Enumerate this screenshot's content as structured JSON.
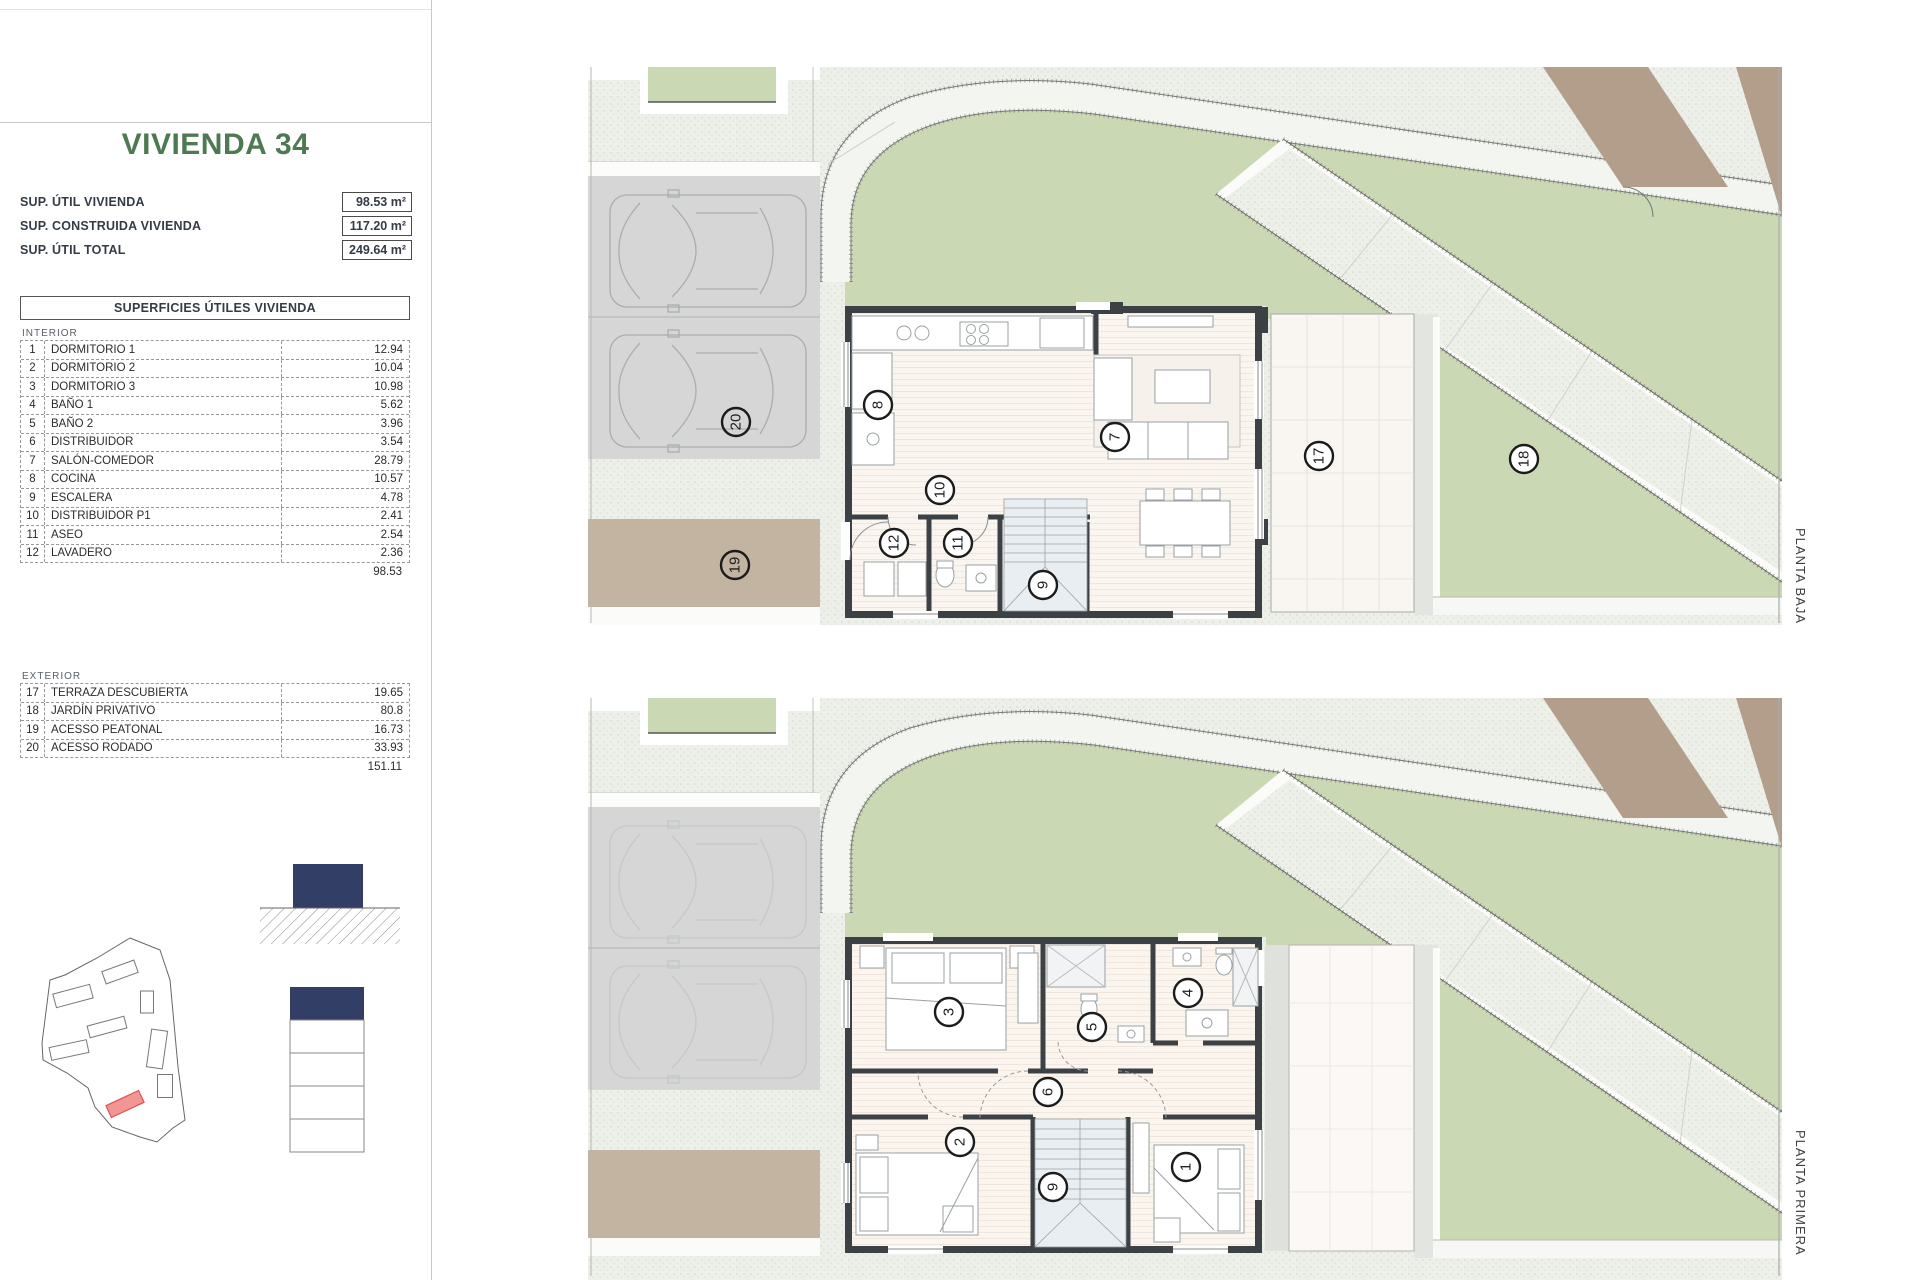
{
  "header": {
    "title": "VIVIENDA 34",
    "summary": [
      {
        "label": "SUP. ÚTIL VIVIENDA",
        "value": "98.53 m²"
      },
      {
        "label": "SUP. CONSTRUIDA VIVIENDA",
        "value": "117.20 m²"
      },
      {
        "label": "SUP. ÚTIL TOTAL",
        "value": "249.64 m²"
      }
    ]
  },
  "areas_table": {
    "title": "SUPERFICIES ÚTILES VIVIENDA",
    "interior": {
      "section_label": "INTERIOR",
      "rows": [
        {
          "num": "1",
          "name": "DORMITORIO 1",
          "value": "12.94"
        },
        {
          "num": "2",
          "name": "DORMITORIO 2",
          "value": "10.04"
        },
        {
          "num": "3",
          "name": "DORMITORIO 3",
          "value": "10.98"
        },
        {
          "num": "4",
          "name": "BAÑO 1",
          "value": "5.62"
        },
        {
          "num": "5",
          "name": "BAÑO 2",
          "value": "3.96"
        },
        {
          "num": "6",
          "name": "DISTRIBUIDOR",
          "value": "3.54"
        },
        {
          "num": "7",
          "name": "SALÓN-COMEDOR",
          "value": "28.79"
        },
        {
          "num": "8",
          "name": "COCINA",
          "value": "10.57"
        },
        {
          "num": "9",
          "name": "ESCALERA",
          "value": "4.78"
        },
        {
          "num": "10",
          "name": "DISTRIBUIDOR P1",
          "value": "2.41"
        },
        {
          "num": "11",
          "name": "ASEO",
          "value": "2.54"
        },
        {
          "num": "12",
          "name": "LAVADERO",
          "value": "2.36"
        }
      ],
      "total": "98.53"
    },
    "exterior": {
      "section_label": "EXTERIOR",
      "rows": [
        {
          "num": "17",
          "name": "TERRAZA DESCUBIERTA",
          "value": "19.65"
        },
        {
          "num": "18",
          "name": "JARDÍN PRIVATIVO",
          "value": "80.8"
        },
        {
          "num": "19",
          "name": "ACESSO PEATONAL",
          "value": "16.73"
        },
        {
          "num": "20",
          "name": "ACESSO RODADO",
          "value": "33.93"
        }
      ],
      "total": "151.11"
    }
  },
  "plans": {
    "baja": {
      "side_label": "PLANTA BAJA",
      "rooms": {
        "cocina": "8",
        "salon": "7",
        "hall": "10",
        "aseo": "11",
        "lavadero": "12",
        "escalera": "9",
        "terraza": "17",
        "jardin": "18",
        "peatonal": "19",
        "rodado": "20"
      }
    },
    "primera": {
      "side_label": "PLANTA PRIMERA",
      "rooms": {
        "dormitorio3": "3",
        "bano2": "5",
        "bano1": "4",
        "distribuidor": "6",
        "dormitorio2": "2",
        "escalera": "9",
        "dormitorio1": "1"
      }
    }
  },
  "colors": {
    "title_green": "#4d7a51",
    "lawn": "#cbd8b4",
    "tan_path": "#c3b3a1",
    "brown_strip": "#b29e8b",
    "navy": "#323e66",
    "highlight_red": "#f19694"
  }
}
